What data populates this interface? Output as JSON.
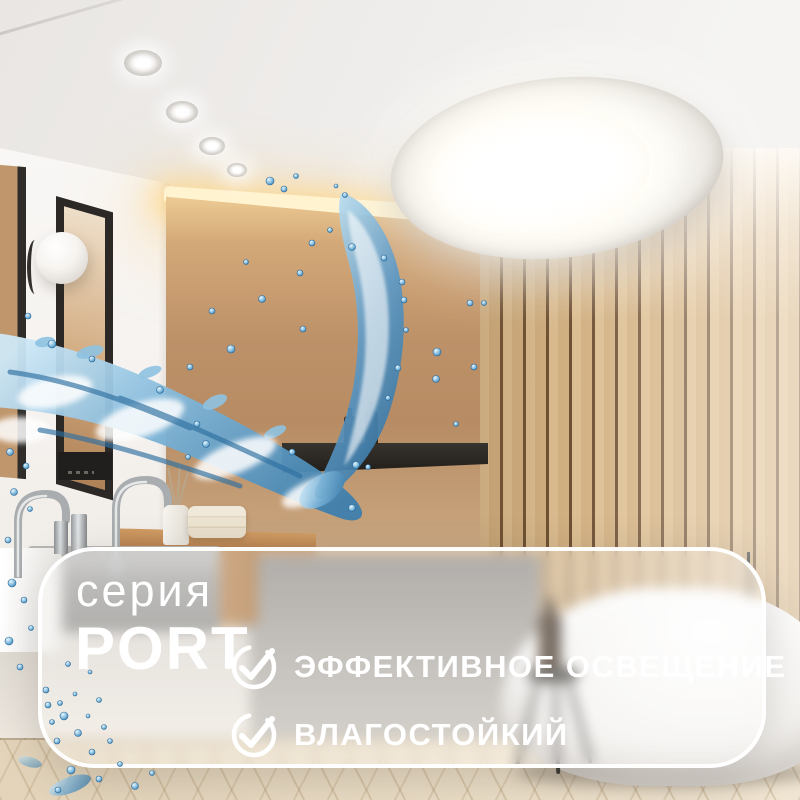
{
  "overlay_card": {
    "series_label": "серия",
    "series_name": "PORT",
    "features": [
      {
        "icon": "check-circle-icon",
        "label": "ЭФФЕКТИВНОЕ ОСВЕЩЕНИЕ"
      },
      {
        "icon": "check-circle-icon",
        "label": "ВЛАГОСТОЙКИЙ"
      }
    ],
    "text_color": "#ffffff",
    "border_color": "#ffffff"
  },
  "colors": {
    "water_blue": "#4a90c2",
    "water_deep": "#2d6fa0",
    "water_light": "#cfe9f7",
    "wood_slat": "#d2b183",
    "slat_gap": "#6e5134",
    "wall_tan": "#bd9168",
    "cove_glow": "#fff3d0",
    "ceiling": "#efedeb",
    "tub_white": "#f4f2ef"
  }
}
